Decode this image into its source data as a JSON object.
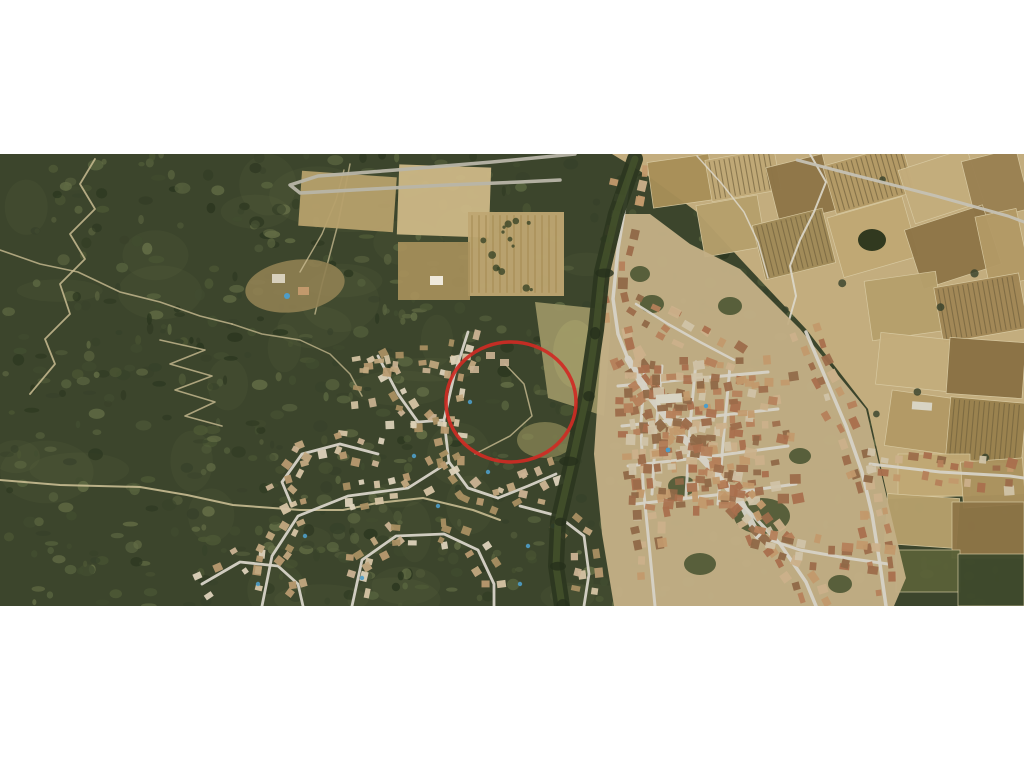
{
  "window": {
    "background_color": "#ffffff",
    "width_px": 1024,
    "height_px": 768
  },
  "aerial_photo": {
    "type": "satellite-aerial-photograph",
    "description": "Aerial photograph of a hillside town: dark forested hills with winding dirt trails on the left, tan farm field parcels and vineyard rows at the top right, a dense village of brown-roofed buildings and light streets on the right, and a residential suburb with curving streets at the bottom centre. A red circle annotation highlights a wooded plot between the suburb and the village.",
    "top_offset_px": 154,
    "width_px": 1024,
    "height_px": 452,
    "regions": [
      {
        "name": "forest-hillside",
        "position": "left",
        "features": "dark green woodland with zig-zag light trails"
      },
      {
        "name": "centre-fields",
        "position": "top-centre",
        "features": "ploughed tan fields, isolated farmhouse, hairpin road"
      },
      {
        "name": "farmland-parcels",
        "position": "top-right",
        "features": "patchwork of tan, brown and olive cultivated plots with vineyard rows"
      },
      {
        "name": "village-centre",
        "position": "right",
        "features": "dense small buildings with brown tiled roofs, grid of light streets, wide avenue"
      },
      {
        "name": "residential-suburb",
        "position": "bottom-centre",
        "features": "detached houses, curving streets, small blue swimming pools"
      },
      {
        "name": "stream-tree-line",
        "position": "centre",
        "features": "dark riparian tree corridor separating suburb from village"
      }
    ],
    "annotation": {
      "shape": "ellipse",
      "purpose": "highlighted-area",
      "center_x_px": 511,
      "center_y_px": 248,
      "radius_x_px": 65,
      "radius_y_px": 60,
      "stroke_width_px": 3.5,
      "color": "#cf2b24"
    },
    "palette": {
      "forest_dark": "#2c3720",
      "forest_base": "#3c452c",
      "forest_light": "#59643f",
      "trail": "#c9bc92",
      "field_tan": "#b6a06c",
      "field_light": "#cdb887",
      "field_brown": "#8e7547",
      "field_olive": "#9a9464",
      "farm_base": "#c3ad7e",
      "village_ground": "#c2ae85",
      "road_gray": "#b8b5a8",
      "street_light": "#d6d2c6",
      "roof_brown": "#a96f4d",
      "roof_tan": "#c2996c",
      "roof_light": "#d0c3a8",
      "pool_blue": "#4e9dc8",
      "annotation_red": "#cf2b24"
    }
  }
}
